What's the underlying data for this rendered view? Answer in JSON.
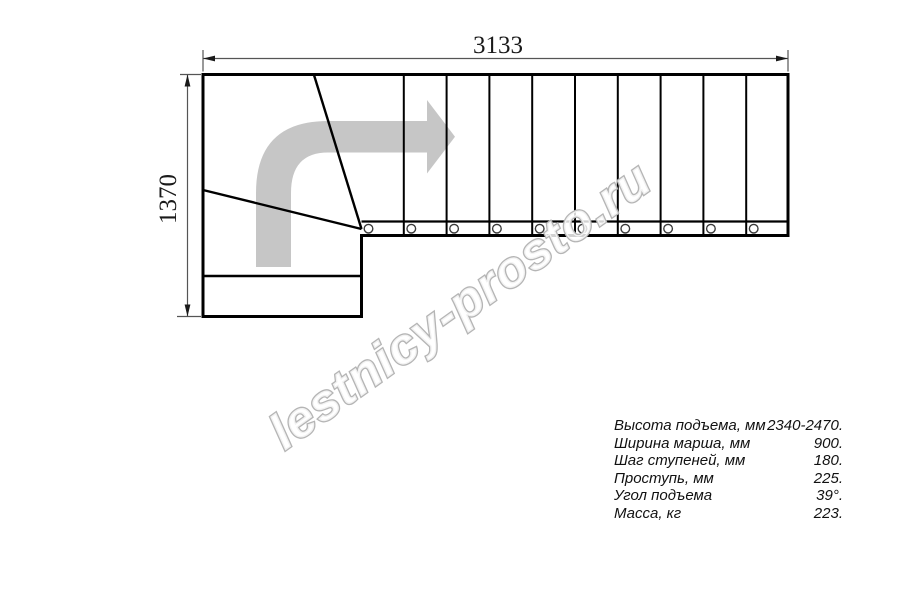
{
  "dimensions": {
    "width_mm": "3133",
    "height_mm": "1370"
  },
  "watermark": {
    "text": "lestnicy-prosto.ru"
  },
  "drawing": {
    "flight_step_count": 10,
    "winder_step_count": 3,
    "direction": "turn-right-then-straight",
    "colors": {
      "line": "#000000",
      "dimension": "#555555",
      "arrow_fill": "#c6c6c6",
      "watermark_outline": "#b5b5b5"
    }
  },
  "specs": {
    "rows": [
      {
        "label": "Высота подъема, мм",
        "value": "2340-2470."
      },
      {
        "label": "Ширина марша, мм",
        "value": "900."
      },
      {
        "label": "Шаг ступеней, мм",
        "value": "180."
      },
      {
        "label": "Проступь, мм",
        "value": "225."
      },
      {
        "label": "Угол подъема",
        "value": "39°."
      },
      {
        "label": "Масса, кг",
        "value": "223."
      }
    ]
  }
}
